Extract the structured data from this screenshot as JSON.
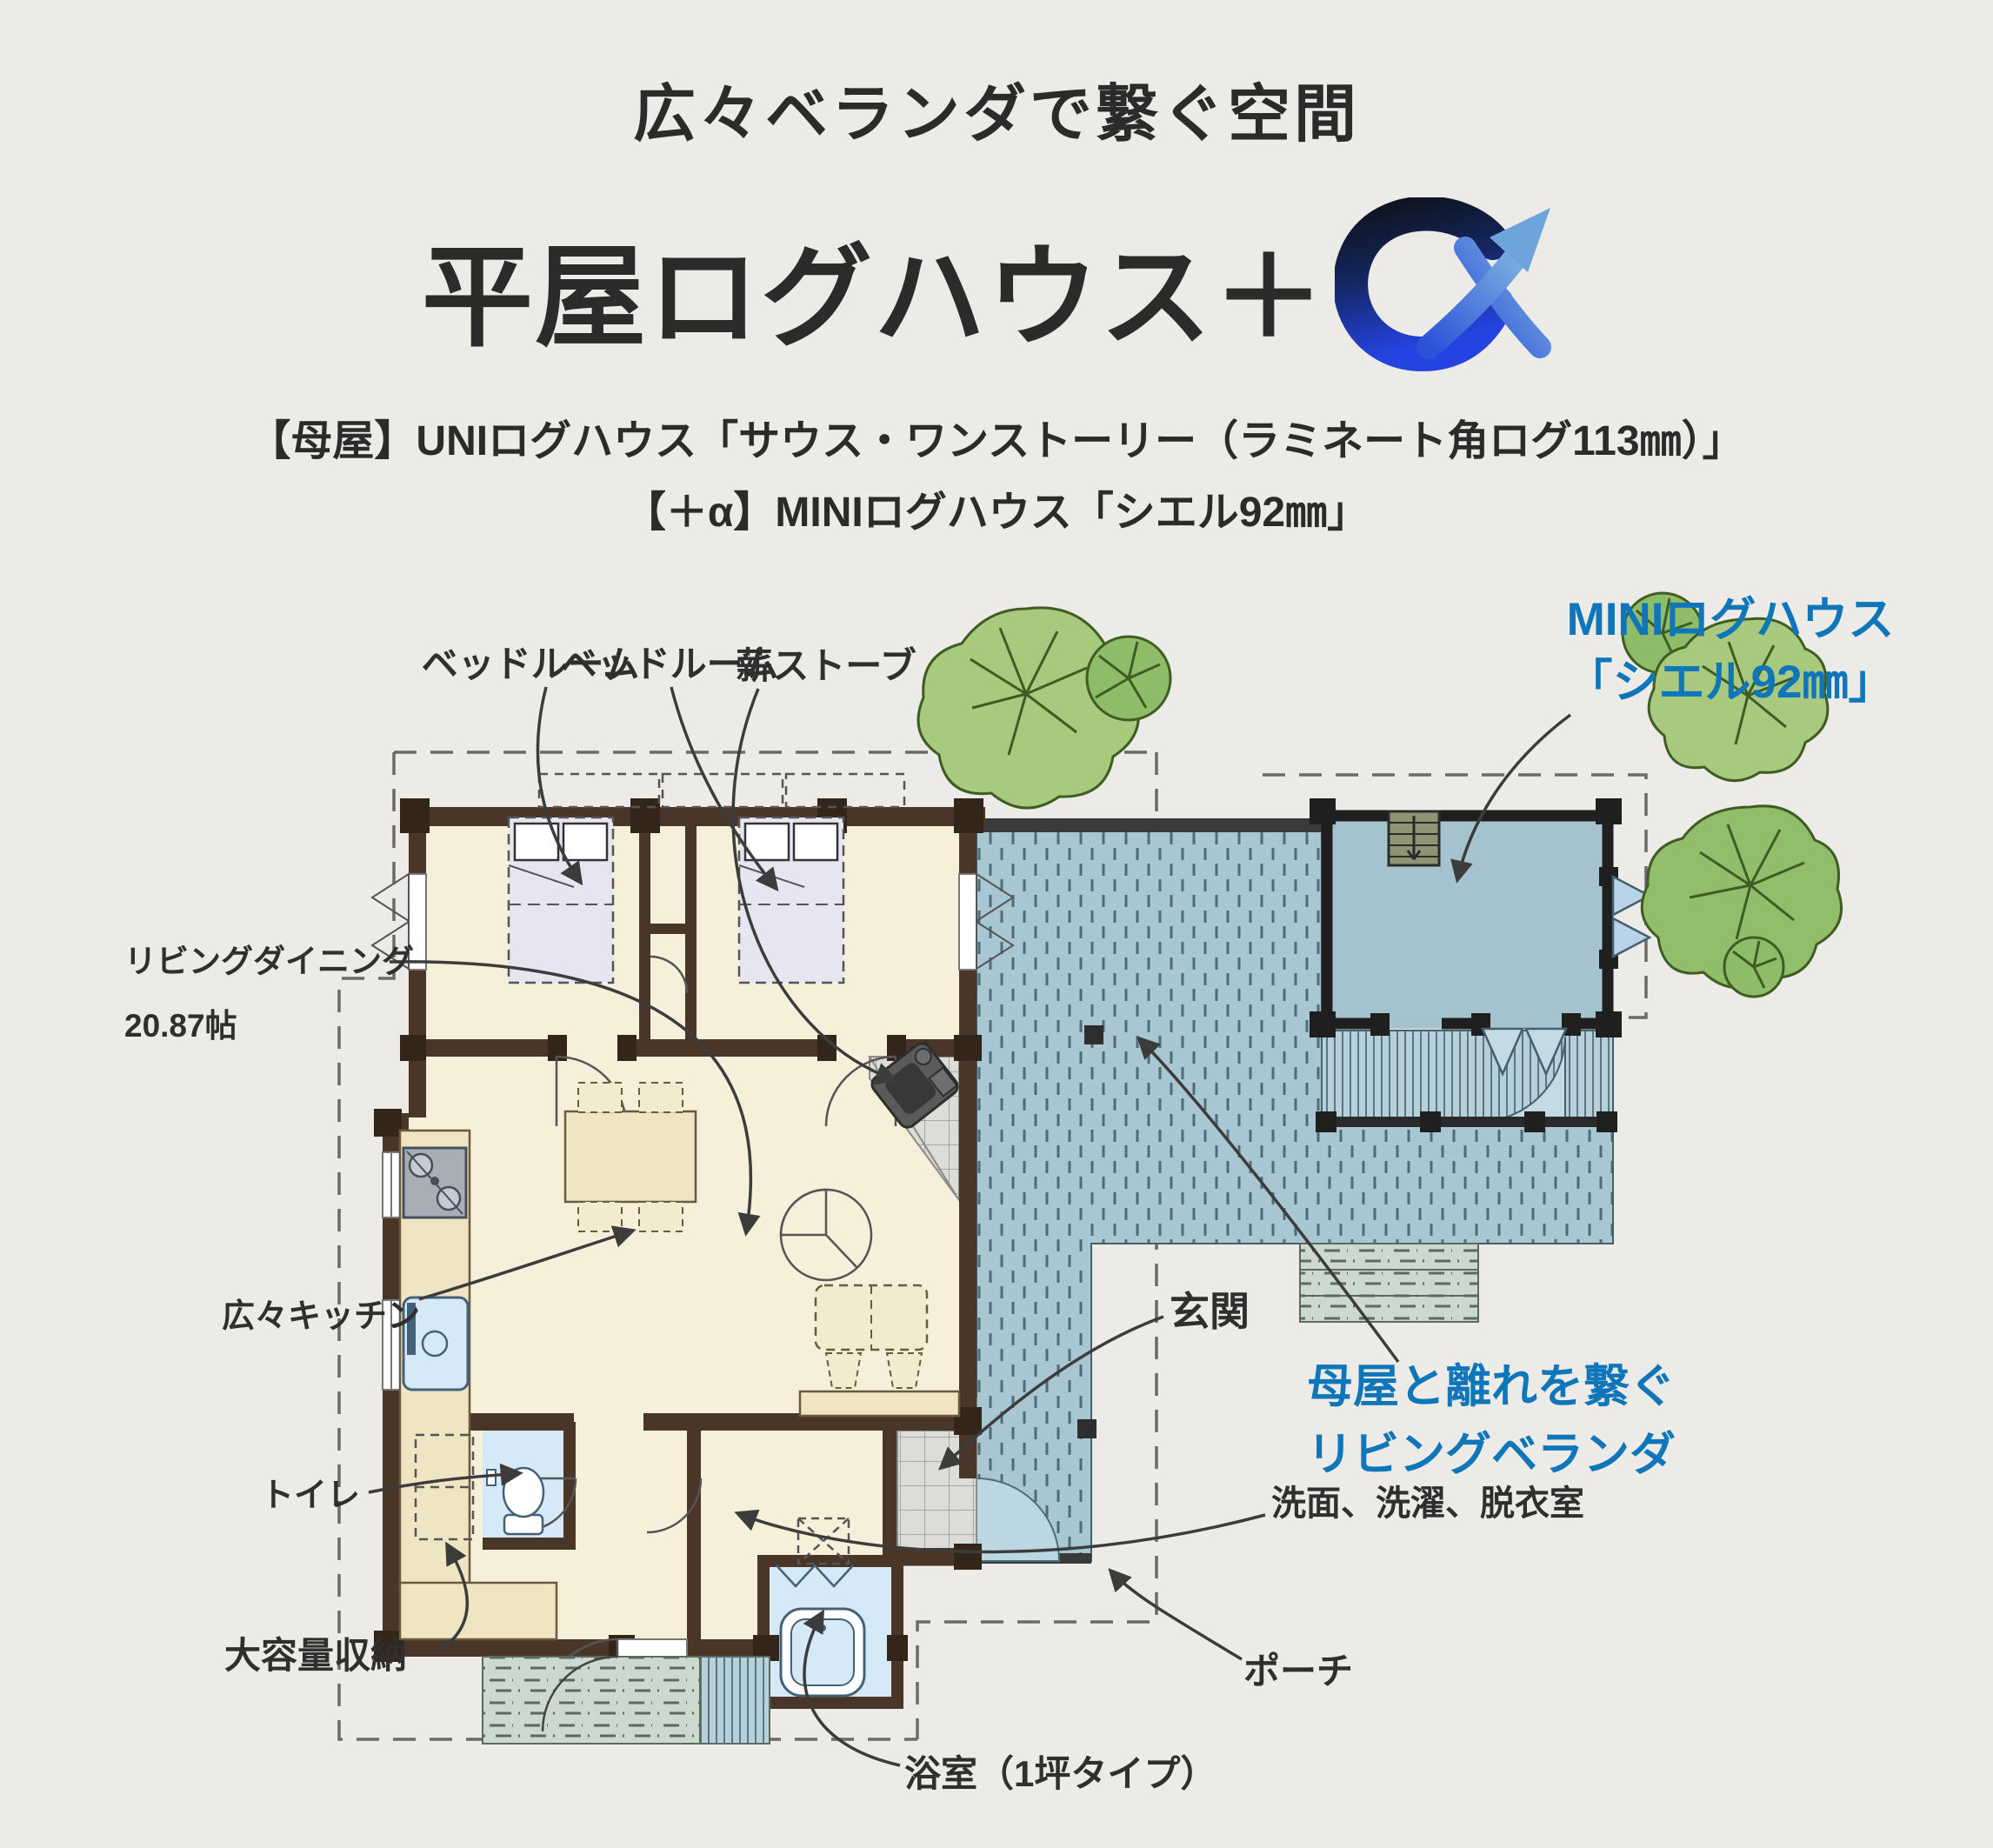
{
  "header": {
    "eyebrow": "広々ベランダで繋ぐ空間",
    "title": "平屋ログハウス＋",
    "logo": "alpha-arrow-logo",
    "subtitle_line1": "【母屋】UNIログハウス「サウス・ワンストーリー（ラミネート角ログ113㎜）」",
    "subtitle_line2": "【＋α】MINIログハウス「シエル92㎜」"
  },
  "plan": {
    "labels": {
      "bedroom1": "ベッドルーム",
      "bedroom2": "ベッドルーム",
      "wood_stove": "薪ストーブ",
      "mini_line1": "MINIログハウス",
      "mini_line2": "「シエル92㎜」",
      "living_line1": "リビングダイニング",
      "living_line2": "20.87帖",
      "kitchen": "広々キッチン",
      "toilet": "トイレ",
      "storage": "大容量収納",
      "entrance": "玄関",
      "veranda_line1": "母屋と離れを繋ぐ",
      "veranda_line2": "リビングベランダ",
      "washroom": "洗面、洗濯、脱衣室",
      "porch": "ポーチ",
      "bathroom": "浴室（1坪タイプ）"
    },
    "colors": {
      "accent_blue": "#0F76BA",
      "deck": "#A9C7D2",
      "floor": "#F6EFD9",
      "wall": "#4A3628",
      "mini_interior": "#A4C3CE",
      "tree_green": "#A9C97E",
      "text": "#2B2B2B"
    }
  }
}
